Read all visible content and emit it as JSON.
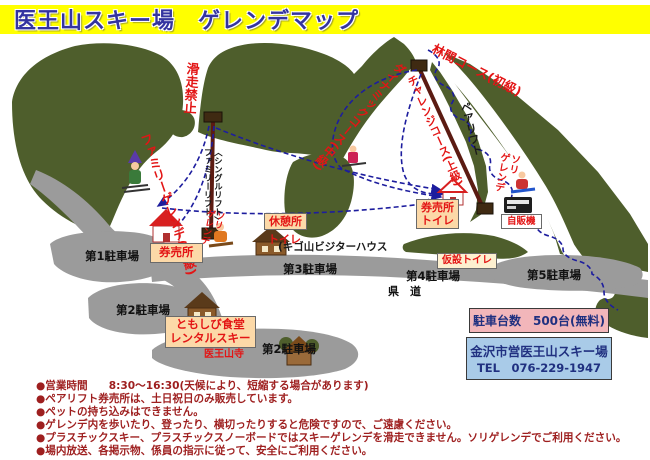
{
  "title": "医王山スキー場　ゲレンデマップ",
  "map": {
    "no_entry": "滑走禁止",
    "courses": {
      "family": "ファミリーゲレンデ(初級)",
      "dynamic": "ダイナミックコース(中級)",
      "challenge": "チャレンジコース(上級)",
      "forest": "林間コース(初級)",
      "sled": "ソリ\nゲレンデ"
    },
    "lifts": {
      "single": "ファミリーリフト",
      "single_sub": "〈シングルリフト〉",
      "pair": "ペアリフト"
    },
    "facilities": {
      "rest_house": "休憩所",
      "rest_house_toilet": "トイレ",
      "visitor_house": "(キゴ山ビジターハウス",
      "ticket_left": "券売所",
      "ticket_right": "券売所",
      "ticket_right_toilet": "トイレ",
      "vending": "自販機",
      "temp_toilet": "仮設トイレ",
      "restaurant_line1": "ともしび食堂",
      "restaurant_line2": "レンタルスキー",
      "temple": "医王山寺"
    },
    "parking": [
      "第1駐車場",
      "第2駐車場",
      "第3駐車場",
      "第4駐車場",
      "第5駐車場",
      "第2駐車場"
    ],
    "road": "県　道"
  },
  "info": {
    "capacity": "駐車台数　500台(無料)",
    "operator": "金沢市営医王山スキー場",
    "tel": "TEL　076-229-1947"
  },
  "notes": [
    "●営業時間　　8:30～16:30(天候により、短縮する場合があります)",
    "●ペアリフト券売所は、土日祝日のみ販売しています。",
    "●ペットの持ち込みはできません。",
    "●ゲレンデ内を歩いたり、登ったり、横切ったりすると危険ですので、ご遠慮ください。",
    "●プラスチックスキー、プラスチックスノーボードではスキーゲレンデを滑走できません。ソリゲレンデでご利用ください。",
    "●場内放送、各掲示物、係員の指示に従って、安全にご利用ください。"
  ]
}
